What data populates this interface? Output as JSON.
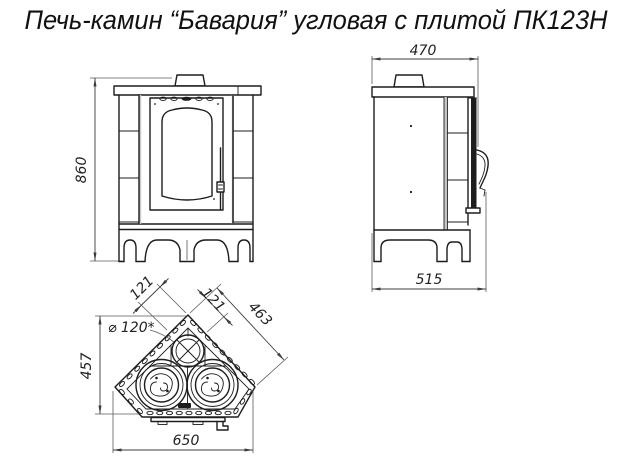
{
  "title": "Печь-камин “Бавария” угловая с плитой ПК123Н",
  "colors": {
    "line": "#1d1d1d",
    "background": "#ffffff"
  },
  "drawing": {
    "front_view": {
      "height_mm": "860"
    },
    "side_view": {
      "top_width_mm": "470",
      "bottom_depth_mm": "515"
    },
    "plan_view": {
      "depth_mm": "457",
      "width_mm": "650",
      "left_edge_mm": "121",
      "right_edge_mm": "121",
      "diagonal_mm": "463",
      "flue_label": "⌀ 120*"
    }
  }
}
